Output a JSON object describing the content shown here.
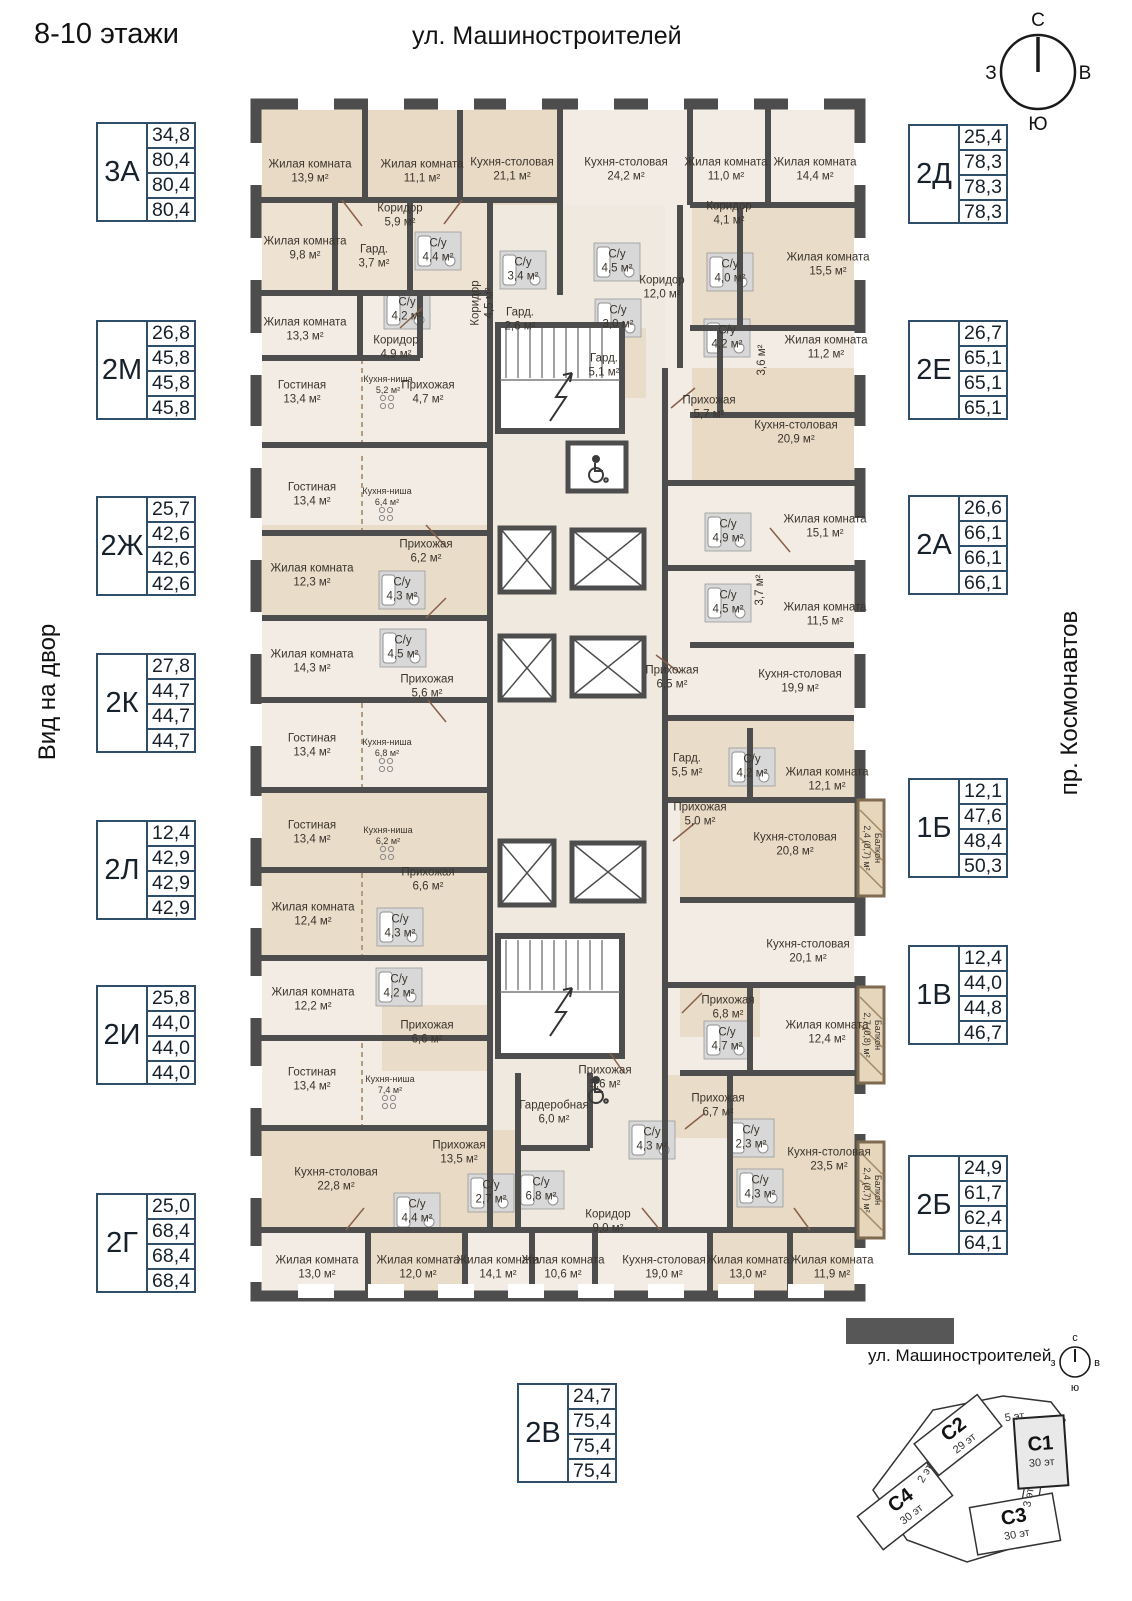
{
  "header": {
    "title": "8-10 этажи",
    "street_top": "ул. Машиностроителей",
    "view_left": "Вид на двор",
    "avenue_right": "пр. Космонавтов"
  },
  "compass": {
    "n": "С",
    "e": "В",
    "s": "Ю",
    "w": "З"
  },
  "legends": [
    {
      "code": "3А",
      "areas": [
        "34,8",
        "80,4",
        "80,4",
        "80,4"
      ],
      "x": 96,
      "y": 122
    },
    {
      "code": "2М",
      "areas": [
        "26,8",
        "45,8",
        "45,8",
        "45,8"
      ],
      "x": 96,
      "y": 320
    },
    {
      "code": "2Ж",
      "areas": [
        "25,7",
        "42,6",
        "42,6",
        "42,6"
      ],
      "x": 96,
      "y": 496
    },
    {
      "code": "2К",
      "areas": [
        "27,8",
        "44,7",
        "44,7",
        "44,7"
      ],
      "x": 96,
      "y": 653
    },
    {
      "code": "2Л",
      "areas": [
        "12,4",
        "42,9",
        "42,9",
        "42,9"
      ],
      "x": 96,
      "y": 820
    },
    {
      "code": "2И",
      "areas": [
        "25,8",
        "44,0",
        "44,0",
        "44,0"
      ],
      "x": 96,
      "y": 985
    },
    {
      "code": "2Г",
      "areas": [
        "25,0",
        "68,4",
        "68,4",
        "68,4"
      ],
      "x": 96,
      "y": 1193
    },
    {
      "code": "2Д",
      "areas": [
        "25,4",
        "78,3",
        "78,3",
        "78,3"
      ],
      "x": 908,
      "y": 124
    },
    {
      "code": "2Е",
      "areas": [
        "26,7",
        "65,1",
        "65,1",
        "65,1"
      ],
      "x": 908,
      "y": 320
    },
    {
      "code": "2А",
      "areas": [
        "26,6",
        "66,1",
        "66,1",
        "66,1"
      ],
      "x": 908,
      "y": 495
    },
    {
      "code": "1Б",
      "areas": [
        "12,1",
        "47,6",
        "48,4",
        "50,3"
      ],
      "x": 908,
      "y": 778
    },
    {
      "code": "1В",
      "areas": [
        "12,4",
        "44,0",
        "44,8",
        "46,7"
      ],
      "x": 908,
      "y": 945
    },
    {
      "code": "2Б",
      "areas": [
        "24,9",
        "61,7",
        "62,4",
        "64,1"
      ],
      "x": 908,
      "y": 1155
    },
    {
      "code": "2В",
      "areas": [
        "24,7",
        "75,4",
        "75,4",
        "75,4"
      ],
      "x": 517,
      "y": 1383
    }
  ],
  "rooms": [
    {
      "t": "Жилая комната",
      "a": "13,9 м²",
      "x": 60,
      "y": 84
    },
    {
      "t": "Жилая комната",
      "a": "11,1 м²",
      "x": 172,
      "y": 84
    },
    {
      "t": "Кухня-столовая",
      "a": "21,1 м²",
      "x": 262,
      "y": 82
    },
    {
      "t": "Кухня-столовая",
      "a": "24,2 м²",
      "x": 376,
      "y": 82
    },
    {
      "t": "Жилая комната",
      "a": "11,0 м²",
      "x": 476,
      "y": 82
    },
    {
      "t": "Жилая комната",
      "a": "14,4 м²",
      "x": 565,
      "y": 82
    },
    {
      "t": "Коридор",
      "a": "5,9 м²",
      "x": 150,
      "y": 128
    },
    {
      "t": "Коридор",
      "a": "4,1 м²",
      "x": 479,
      "y": 126
    },
    {
      "t": "Жилая комната",
      "a": "9,8 м²",
      "x": 55,
      "y": 161
    },
    {
      "t": "Гард.",
      "a": "3,7 м²",
      "x": 124,
      "y": 169
    },
    {
      "t": "С/у",
      "a": "4,4 м²",
      "x": 188,
      "y": 163
    },
    {
      "t": "С/у",
      "a": "3,4 м²",
      "x": 273,
      "y": 182
    },
    {
      "t": "С/у",
      "a": "4,5 м²",
      "x": 367,
      "y": 174
    },
    {
      "t": "Коридор",
      "a": "12,0 м²",
      "x": 412,
      "y": 200
    },
    {
      "t": "С/у",
      "a": "4,0 м²",
      "x": 480,
      "y": 184
    },
    {
      "t": "Жилая комната",
      "a": "15,5 м²",
      "x": 578,
      "y": 177
    },
    {
      "t": "Жилая комната",
      "a": "13,3 м²",
      "x": 55,
      "y": 242
    },
    {
      "t": "С/у",
      "a": "4,2 м²",
      "x": 157,
      "y": 222
    },
    {
      "t": "Коридор",
      "a": "4,9 м²",
      "x": 146,
      "y": 260
    },
    {
      "t": "Коридор",
      "a": "4,5 м²",
      "x": 233,
      "y": 215,
      "r": -90
    },
    {
      "t": "Гард.",
      "a": "2,6 м²",
      "x": 270,
      "y": 232
    },
    {
      "t": "С/у",
      "a": "3,0 м²",
      "x": 368,
      "y": 230
    },
    {
      "t": "С/у",
      "a": "4,2 м²",
      "x": 477,
      "y": 250
    },
    {
      "t": "",
      "a": "3,6 м²",
      "x": 512,
      "y": 272,
      "r": -90
    },
    {
      "t": "Жилая комната",
      "a": "11,2 м²",
      "x": 576,
      "y": 260
    },
    {
      "t": "Гостиная",
      "a": "13,4 м²",
      "x": 52,
      "y": 305
    },
    {
      "t": "Кухня-ниша",
      "a": "5,2 м²",
      "x": 138,
      "y": 297,
      "s": 1
    },
    {
      "t": "Прихожая",
      "a": "4,7 м²",
      "x": 178,
      "y": 305
    },
    {
      "t": "Гард.",
      "a": "5,1 м²",
      "x": 354,
      "y": 278
    },
    {
      "t": "Прихожая",
      "a": "5,7 м²",
      "x": 459,
      "y": 320
    },
    {
      "t": "Кухня-столовая",
      "a": "20,9 м²",
      "x": 546,
      "y": 345
    },
    {
      "t": "Гостиная",
      "a": "13,4 м²",
      "x": 62,
      "y": 407
    },
    {
      "t": "Кухня-ниша",
      "a": "6,4 м²",
      "x": 137,
      "y": 409,
      "s": 1
    },
    {
      "t": "Прихожая",
      "a": "6,2 м²",
      "x": 176,
      "y": 464
    },
    {
      "t": "Жилая комната",
      "a": "12,3 м²",
      "x": 62,
      "y": 488
    },
    {
      "t": "С/у",
      "a": "4,3 м²",
      "x": 152,
      "y": 502
    },
    {
      "t": "С/у",
      "a": "4,9 м²",
      "x": 478,
      "y": 444
    },
    {
      "t": "Жилая комната",
      "a": "15,1 м²",
      "x": 575,
      "y": 439
    },
    {
      "t": "Жилая комната",
      "a": "14,3 м²",
      "x": 62,
      "y": 574
    },
    {
      "t": "С/у",
      "a": "4,5 м²",
      "x": 153,
      "y": 560
    },
    {
      "t": "",
      "a": "3,7 м²",
      "x": 510,
      "y": 502,
      "r": -90
    },
    {
      "t": "С/у",
      "a": "4,5 м²",
      "x": 478,
      "y": 515
    },
    {
      "t": "Жилая комната",
      "a": "11,5 м²",
      "x": 575,
      "y": 527
    },
    {
      "t": "Прихожая",
      "a": "5,6 м²",
      "x": 177,
      "y": 599
    },
    {
      "t": "Прихожая",
      "a": "6,5 м²",
      "x": 422,
      "y": 590
    },
    {
      "t": "Кухня-столовая",
      "a": "19,9 м²",
      "x": 550,
      "y": 594
    },
    {
      "t": "Гостиная",
      "a": "13,4 м²",
      "x": 62,
      "y": 658
    },
    {
      "t": "Кухня-ниша",
      "a": "6,8 м²",
      "x": 137,
      "y": 660,
      "s": 1
    },
    {
      "t": "Гард.",
      "a": "5,5 м²",
      "x": 437,
      "y": 678
    },
    {
      "t": "С/у",
      "a": "4,2 м²",
      "x": 502,
      "y": 679
    },
    {
      "t": "Жилая комната",
      "a": "12,1 м²",
      "x": 577,
      "y": 692
    },
    {
      "t": "Гостиная",
      "a": "13,4 м²",
      "x": 62,
      "y": 745
    },
    {
      "t": "Кухня-ниша",
      "a": "6,2 м²",
      "x": 138,
      "y": 748,
      "s": 1
    },
    {
      "t": "Прихожая",
      "a": "5,0 м²",
      "x": 450,
      "y": 727
    },
    {
      "t": "Кухня-столовая",
      "a": "20,8 м²",
      "x": 545,
      "y": 757
    },
    {
      "t": "Балкон",
      "a": "2,4 (0,7) м²",
      "x": 622,
      "y": 760,
      "r": 90,
      "s": 1
    },
    {
      "t": "Прихожая",
      "a": "6,6 м²",
      "x": 178,
      "y": 792
    },
    {
      "t": "Жилая комната",
      "a": "12,4 м²",
      "x": 63,
      "y": 827
    },
    {
      "t": "С/у",
      "a": "4,3 м²",
      "x": 150,
      "y": 839
    },
    {
      "t": "С/у",
      "a": "4,2 м²",
      "x": 149,
      "y": 899
    },
    {
      "t": "Жилая комната",
      "a": "12,2 м²",
      "x": 63,
      "y": 912
    },
    {
      "t": "Кухня-столовая",
      "a": "20,1 м²",
      "x": 558,
      "y": 864
    },
    {
      "t": "Прихожая",
      "a": "6,8 м²",
      "x": 478,
      "y": 920
    },
    {
      "t": "С/у",
      "a": "4,7 м²",
      "x": 477,
      "y": 952
    },
    {
      "t": "Жилая комната",
      "a": "12,4 м²",
      "x": 577,
      "y": 945
    },
    {
      "t": "Балкон",
      "a": "2,7 (0,8) м²",
      "x": 622,
      "y": 947,
      "r": 90,
      "s": 1
    },
    {
      "t": "Прихожая",
      "a": "6,6 м²",
      "x": 177,
      "y": 945
    },
    {
      "t": "Гостиная",
      "a": "13,4 м²",
      "x": 62,
      "y": 992
    },
    {
      "t": "Кухня-ниша",
      "a": "7,4 м²",
      "x": 140,
      "y": 997,
      "s": 1
    },
    {
      "t": "Прихожая",
      "a": "5,6 м²",
      "x": 355,
      "y": 990
    },
    {
      "t": "Гардеробная",
      "a": "6,0 м²",
      "x": 304,
      "y": 1025
    },
    {
      "t": "Прихожая",
      "a": "13,5 м²",
      "x": 209,
      "y": 1065
    },
    {
      "t": "Прихожая",
      "a": "6,7 м²",
      "x": 468,
      "y": 1018
    },
    {
      "t": "Кухня-столовая",
      "a": "23,5 м²",
      "x": 579,
      "y": 1072
    },
    {
      "t": "Кухня-столовая",
      "a": "22,8 м²",
      "x": 86,
      "y": 1092
    },
    {
      "t": "С/у",
      "a": "6,8 м²",
      "x": 291,
      "y": 1102
    },
    {
      "t": "С/у",
      "a": "4,3 м²",
      "x": 402,
      "y": 1052
    },
    {
      "t": "С/у",
      "a": "2,3 м²",
      "x": 501,
      "y": 1050
    },
    {
      "t": "С/у",
      "a": "4,3 м²",
      "x": 510,
      "y": 1100
    },
    {
      "t": "С/у",
      "a": "4,4 м²",
      "x": 167,
      "y": 1124
    },
    {
      "t": "С/у",
      "a": "2,7 м²",
      "x": 241,
      "y": 1105
    },
    {
      "t": "Коридор",
      "a": "9,0 м²",
      "x": 358,
      "y": 1134
    },
    {
      "t": "Балкон",
      "a": "2,4 (0,7) м²",
      "x": 622,
      "y": 1102,
      "r": 90,
      "s": 1
    },
    {
      "t": "Жилая комната",
      "a": "13,0 м²",
      "x": 67,
      "y": 1180
    },
    {
      "t": "Жилая комната",
      "a": "12,0 м²",
      "x": 168,
      "y": 1180
    },
    {
      "t": "Жилая комната",
      "a": "14,1 м²",
      "x": 248,
      "y": 1180
    },
    {
      "t": "Жилая комната",
      "a": "10,6 м²",
      "x": 313,
      "y": 1180
    },
    {
      "t": "Кухня-столовая",
      "a": "19,0 м²",
      "x": 414,
      "y": 1180
    },
    {
      "t": "Жилая комната",
      "a": "13,0 м²",
      "x": 498,
      "y": 1180
    },
    {
      "t": "Жилая комната",
      "a": "11,9 м²",
      "x": 582,
      "y": 1180
    }
  ],
  "minimap": {
    "street": "ул. Машиностроителей",
    "avenue": "пр. Космонавтов",
    "compass": {
      "n": "с",
      "e": "в",
      "s": "ю",
      "w": "з"
    },
    "buildings": [
      {
        "name": "С2",
        "floors": "29 эт"
      },
      {
        "name": "С1",
        "floors": "30 эт"
      },
      {
        "name": "С4",
        "floors": "30 эт"
      },
      {
        "name": "С3",
        "floors": "30 эт"
      }
    ],
    "links": [
      {
        "label": "5 эт"
      },
      {
        "label": "2 эт"
      },
      {
        "label": "3 эт"
      }
    ]
  }
}
